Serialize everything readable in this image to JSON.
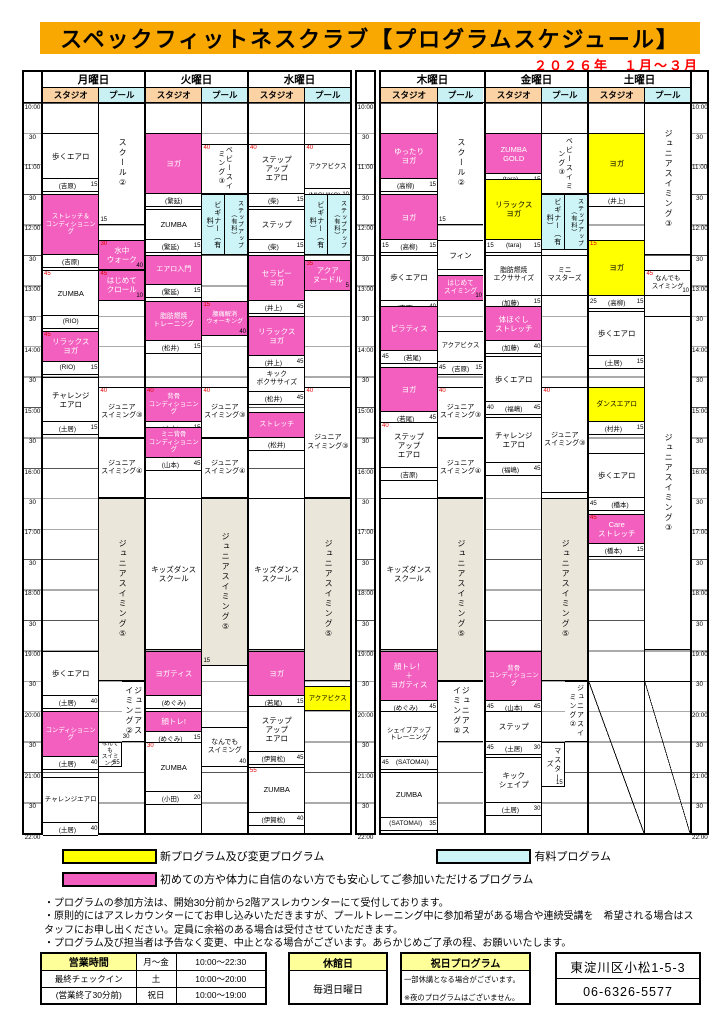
{
  "title": "スペックフィットネスクラブ【プログラムスケジュール】",
  "period": "２０２６年　１月～３月",
  "areas": [
    "スタジオ",
    "プール"
  ],
  "time_labels": [
    "10:00",
    "30",
    "11:00",
    "30",
    "12:00",
    "30",
    "13:00",
    "30",
    "14:00",
    "30",
    "15:00",
    "30",
    "16:00",
    "30",
    "17:00",
    "30",
    "18:00",
    "30",
    "19:00",
    "30",
    "20:00",
    "30",
    "21:00",
    "30",
    "22:00"
  ],
  "colors": {
    "accent_orange": "#F8A800",
    "studio_header": "#FAD2A4",
    "pool_header": "#C9F0F3",
    "pink": "#F25FBE",
    "yellow": "#FFFF00",
    "paid_blue": "#CDF4F6",
    "beige": "#EAE6DA",
    "red_text": "#FF0000",
    "table_header_yellow": "#FFFF99"
  },
  "days": [
    {
      "name": "月曜日",
      "studio": [
        {
          "t": "歩くエアロ",
          "i": "(吉原)",
          "br": "15",
          "s": "10:30",
          "e": "11:15",
          "c": "white"
        },
        {
          "t": "ストレッチ＆\nコンディショニング",
          "i": "(吉原)",
          "s": "11:30",
          "e": "12:30",
          "c": "pink",
          "fs": 6.3
        },
        {
          "t": "ZUMBA",
          "i": "(RIO)",
          "tl": "45",
          "s": "12:45",
          "e": "13:30",
          "c": "white"
        },
        {
          "t": "リラックス\nヨガ",
          "i": "(RIO)",
          "tl": "45",
          "br": "15",
          "s": "13:45",
          "e": "14:15",
          "c": "pink"
        },
        {
          "t": "チャレンジ\nエアロ",
          "i": "(土居)",
          "br": "15",
          "s": "14:30",
          "e": "15:15",
          "c": "white"
        },
        {
          "t": "歩くエアロ",
          "i": "(土居)",
          "br": "40",
          "s": "19:00",
          "e": "19:45",
          "c": "white"
        },
        {
          "t": "コンディショニング",
          "i": "(土居)",
          "br": "40",
          "s": "20:00",
          "e": "20:45",
          "c": "pink",
          "fs": 6.3
        },
        {
          "t": "チャレンジエアロ",
          "i": "(土居)",
          "br": "40",
          "s": "21:05",
          "e": "21:50",
          "c": "white",
          "fs": 6.5
        }
      ],
      "pool": [
        {
          "t": "スクール②",
          "s": "10:00",
          "e": "12:00",
          "c": "white",
          "v": 1,
          "bl": "15"
        },
        {
          "t": "水中\nウォーク",
          "s": "12:15",
          "e": "12:45",
          "c": "pink",
          "tl": "30",
          "br": "40"
        },
        {
          "t": "はじめて\nクロール",
          "s": "12:45",
          "e": "13:15",
          "c": "pink",
          "tl": "45",
          "br": "10"
        },
        {
          "t": "ジュニア\nスイミング③",
          "s": "14:40",
          "e": "15:30",
          "c": "white",
          "tl": "40",
          "fs": 7
        },
        {
          "t": "ジュニア\nスイミング④",
          "s": "15:30",
          "e": "16:30",
          "c": "white",
          "fs": 7
        },
        {
          "t": "ジュニアスイミング⑤",
          "s": "16:30",
          "e": "19:30",
          "c": "beige",
          "v": 1
        },
        {
          "t": "ジュニアスイミング②",
          "s": "19:30",
          "e": "20:30",
          "c": "white",
          "v": 1,
          "lane": "R",
          "bl": "30"
        },
        {
          "t": "なんでも\nスイミング",
          "s": "20:30",
          "e": "20:55",
          "c": "white",
          "lane": "L",
          "br": "55",
          "fs": 5.6
        }
      ]
    },
    {
      "name": "火曜日",
      "studio": [
        {
          "t": "ヨガ",
          "i": "(繁延)",
          "s": "10:30",
          "e": "11:30",
          "c": "pink"
        },
        {
          "t": "ZUMBA",
          "i": "(繁延)",
          "br": "15",
          "s": "11:45",
          "e": "12:15",
          "c": "white"
        },
        {
          "t": "エアロ入門",
          "i": "(繁延)",
          "br": "15",
          "s": "12:30",
          "e": "13:00",
          "c": "pink",
          "fs": 7
        },
        {
          "t": "脂肪燃焼\nトレーニング",
          "i": "(松井)",
          "br": "15",
          "s": "13:15",
          "e": "13:55",
          "c": "pink",
          "fs": 6.8
        },
        {
          "t": "背骨\nコンディショニング",
          "i": "(山本)",
          "tl": "40",
          "br": "15",
          "s": "14:40",
          "e": "15:15",
          "c": "pink",
          "fs": 6.3
        },
        {
          "t": "ミニ背骨\nコンディショニング",
          "i": "(山本)",
          "br": "45",
          "s": "15:20",
          "e": "15:50",
          "c": "pink",
          "fs": 6.3
        },
        {
          "t": "キッズダンス\nスクール",
          "s": "16:30",
          "e": "19:00",
          "c": "white"
        },
        {
          "t": "ヨガティス",
          "i": "(めぐみ)",
          "s": "19:00",
          "e": "19:45",
          "c": "pink"
        },
        {
          "t": "顔トレ!",
          "i": "(めぐみ)",
          "br": "15",
          "s": "20:00",
          "e": "20:20",
          "c": "pink"
        },
        {
          "t": "ZUMBA",
          "i": "(小田)",
          "tl": "30",
          "br": "20",
          "s": "20:30",
          "e": "21:20",
          "c": "white"
        }
      ],
      "pool": [
        {
          "t": "ベビースイミング③",
          "s": "10:40",
          "e": "11:30",
          "c": "white",
          "v": 1,
          "tl": "40",
          "fs": 7
        },
        {
          "t": "ビギナー（有料）",
          "s": "11:30",
          "e": "12:30",
          "c": "blue",
          "v": 1,
          "lane": "L"
        },
        {
          "t": "ステップアップ（有料）",
          "s": "11:30",
          "e": "12:30",
          "c": "blue",
          "v": 1,
          "lane": "R",
          "fs": 6
        },
        {
          "t": "腰痛解消\nウォーキング",
          "s": "13:15",
          "e": "13:50",
          "c": "pink",
          "tl": "15",
          "br": "40",
          "fs": 6.2
        },
        {
          "t": "ジュニア\nスイミング③",
          "s": "14:40",
          "e": "15:30",
          "c": "white",
          "tl": "40",
          "fs": 7
        },
        {
          "t": "ジュニア\nスイミング④",
          "s": "15:30",
          "e": "16:30",
          "c": "white",
          "fs": 7
        },
        {
          "t": "ジュニアスイミング⑤",
          "s": "16:30",
          "e": "19:15",
          "c": "beige",
          "v": 1,
          "bl": "15"
        },
        {
          "t": "なんでも\nスイミング",
          "s": "20:15",
          "e": "20:55",
          "c": "white",
          "br": "40",
          "fs": 6.8
        }
      ]
    },
    {
      "name": "水曜日",
      "studio": [
        {
          "t": "ステップ\nアップ\nエアロ",
          "i": "(柴)",
          "tl": "40",
          "br": "15",
          "s": "10:40",
          "e": "11:30",
          "c": "white"
        },
        {
          "t": "ステップ",
          "i": "(柴)",
          "br": "15",
          "s": "11:45",
          "e": "12:15",
          "c": "white"
        },
        {
          "t": "セラピー\nヨガ",
          "i": "(井上)",
          "br": "45",
          "s": "12:30",
          "e": "13:15",
          "c": "pink"
        },
        {
          "t": "リラックス\nヨガ",
          "i": "(井上)",
          "br": "45",
          "s": "13:30",
          "e": "14:10",
          "c": "pink"
        },
        {
          "t": "キック\nボクササイズ",
          "i": "(松井)",
          "br": "45",
          "s": "14:20",
          "e": "14:45",
          "c": "white",
          "fs": 6.8
        },
        {
          "t": "ストレッチ",
          "i": "(松井)",
          "s": "15:05",
          "e": "15:30",
          "c": "pink",
          "fs": 7
        },
        {
          "t": "キッズダンス\nスクール",
          "s": "16:30",
          "e": "19:00",
          "c": "white"
        },
        {
          "t": "ヨガ",
          "i": "(若尾)",
          "br": "15",
          "s": "19:00",
          "e": "19:45",
          "c": "pink"
        },
        {
          "t": "ステップ\nアップ\nエアロ",
          "i": "(伊賀松)",
          "br": "45",
          "s": "19:55",
          "e": "20:40",
          "c": "white"
        },
        {
          "t": "ZUMBA",
          "i": "(伊賀松)",
          "tl": "55",
          "br": "40",
          "s": "20:55",
          "e": "21:40",
          "c": "white"
        }
      ],
      "pool": [
        {
          "t": "アクアビクス",
          "i": "(MICHIKO)",
          "tl": "40",
          "br": "10",
          "s": "10:40",
          "e": "11:25",
          "c": "white",
          "fs": 6.4
        },
        {
          "t": "ビギナー（有料）",
          "s": "11:30",
          "e": "12:30",
          "c": "blue",
          "v": 1,
          "lane": "L"
        },
        {
          "t": "ステップアップ（有料）",
          "s": "11:30",
          "e": "12:30",
          "c": "blue",
          "v": 1,
          "lane": "R",
          "fs": 6
        },
        {
          "t": "アクア\nヌードル",
          "s": "12:35",
          "e": "13:05",
          "c": "pink",
          "tl": "35",
          "br": "5"
        },
        {
          "t": "ジュニア\nスイミング③",
          "s": "14:40",
          "e": "16:30",
          "c": "white",
          "tl": "40",
          "fs": 7
        },
        {
          "t": "ジュニアスイミング⑤",
          "s": "16:30",
          "e": "19:30",
          "c": "beige",
          "v": 1
        },
        {
          "t": "アクアビクス",
          "s": "19:35",
          "e": "20:00",
          "c": "yellow",
          "fs": 6.4
        }
      ]
    },
    {
      "name": "木曜日",
      "studio": [
        {
          "t": "ゆったり\nヨガ",
          "i": "(高柳)",
          "br": "15",
          "s": "10:30",
          "e": "11:15",
          "c": "pink"
        },
        {
          "t": "ヨガ",
          "i": "(高柳)",
          "br": "15",
          "bl": "15",
          "s": "11:30",
          "e": "12:15",
          "c": "pink"
        },
        {
          "t": "歩くエアロ",
          "i": "(吉原)",
          "br": "40",
          "s": "12:30",
          "e": "13:15",
          "c": "white"
        },
        {
          "t": "ピラティス",
          "i": "(若尾)",
          "bl": "45",
          "s": "13:20",
          "e": "14:05",
          "c": "pink"
        },
        {
          "t": "ヨガ",
          "i": "(若尾)",
          "br": "45",
          "s": "14:20",
          "e": "15:05",
          "c": "pink"
        },
        {
          "t": "ステップ\nアップ\nエアロ",
          "i": "(吉原)",
          "tl": "40",
          "s": "15:15",
          "e": "16:00",
          "c": "white"
        },
        {
          "t": "キッズダンス\nスクール",
          "s": "16:30",
          "e": "19:00",
          "c": "white"
        },
        {
          "t": "顔トレ！\n＋\nヨガティス",
          "i": "(めぐみ)",
          "br": "45",
          "s": "19:00",
          "e": "19:50",
          "c": "pink"
        },
        {
          "t": "シェイプアップ\nトレーニング",
          "i": "(SATOMAI)",
          "bl": "45",
          "s": "20:00",
          "e": "20:45",
          "c": "white",
          "fs": 6.3
        },
        {
          "t": "ZUMBA",
          "i": "(SATOMAI)",
          "br": "35",
          "s": "21:00",
          "e": "21:45",
          "c": "white"
        }
      ],
      "pool": [
        {
          "t": "スクール②",
          "s": "10:00",
          "e": "12:00",
          "c": "white",
          "v": 1,
          "bl": "15"
        },
        {
          "t": "フィン",
          "s": "12:15",
          "e": "12:45",
          "c": "white"
        },
        {
          "t": "はじめて\nスイミング",
          "s": "12:50",
          "e": "13:15",
          "c": "pink",
          "br": "10",
          "fs": 6.6
        },
        {
          "t": "アクアビクス",
          "i": "(吉原)",
          "br": "15",
          "bl": "45",
          "s": "13:45",
          "e": "14:15",
          "c": "white",
          "fs": 6.4
        },
        {
          "t": "ジュニア\nスイミング③",
          "s": "14:40",
          "e": "15:30",
          "c": "white",
          "tl": "40",
          "fs": 7
        },
        {
          "t": "ジュニア\nスイミング④",
          "s": "15:30",
          "e": "16:30",
          "c": "white",
          "fs": 7
        },
        {
          "t": "ジュニアスイミング⑤",
          "s": "16:30",
          "e": "19:30",
          "c": "beige",
          "v": 1
        },
        {
          "t": "ジュニアスイミング②",
          "s": "19:30",
          "e": "20:30",
          "c": "white",
          "v": 1
        }
      ]
    },
    {
      "name": "金曜日",
      "studio": [
        {
          "t": "ZUMBA\nGOLD",
          "i": "(tara)",
          "br": "15",
          "s": "10:30",
          "e": "11:10",
          "c": "pink"
        },
        {
          "t": "リラックス\nヨガ",
          "i": "(tara)",
          "br": "15",
          "bl": "15",
          "s": "11:15",
          "e": "12:15",
          "c": "yellow"
        },
        {
          "t": "脂肪燃焼\nエクササイズ",
          "i": "(加藤)",
          "br": "15",
          "s": "12:30",
          "e": "13:10",
          "c": "white",
          "fs": 6.8
        },
        {
          "t": "体ほぐし\nストレッチ",
          "i": "(加藤)",
          "br": "40",
          "s": "13:20",
          "e": "13:55",
          "c": "pink"
        },
        {
          "t": "歩くエアロ",
          "i": "(福嶋)",
          "br": "45",
          "bl": "40",
          "s": "14:10",
          "e": "14:55",
          "c": "white"
        },
        {
          "t": "チャレンジ\nエアロ",
          "i": "(福嶋)",
          "br": "45",
          "s": "15:10",
          "e": "15:55",
          "c": "white"
        },
        {
          "t": "背骨\nコンディショニング",
          "i": "(山本)",
          "br": "45",
          "bl": "45",
          "s": "19:00",
          "e": "19:50",
          "c": "pink",
          "fs": 6.3
        },
        {
          "t": "ステップ",
          "i": "(土居)",
          "br": "30",
          "bl": "45",
          "s": "20:00",
          "e": "20:30",
          "c": "white"
        },
        {
          "t": "キック\nシェイプ",
          "i": "(土居)",
          "br": "30",
          "s": "20:45",
          "e": "21:30",
          "c": "white"
        }
      ],
      "pool": [
        {
          "t": "ベビースイミング③",
          "s": "10:30",
          "e": "11:30",
          "c": "white",
          "v": 1,
          "fs": 7
        },
        {
          "t": "ビギナー（有料）",
          "s": "11:30",
          "e": "12:25",
          "c": "blue",
          "v": 1,
          "lane": "L"
        },
        {
          "t": "ステップアップ（有料）",
          "s": "11:30",
          "e": "12:25",
          "c": "blue",
          "v": 1,
          "lane": "R",
          "fs": 6
        },
        {
          "t": "ミニ\nマスターズ",
          "s": "12:30",
          "e": "13:10",
          "c": "white",
          "fs": 6.8
        },
        {
          "t": "ジュニア\nスイミング③",
          "s": "14:40",
          "e": "16:25",
          "c": "white",
          "tl": "40",
          "fs": 7
        },
        {
          "t": "ジュニアスイミング⑤",
          "s": "16:30",
          "e": "19:30",
          "c": "beige",
          "v": 1
        },
        {
          "t": "ジュニアスイミング②",
          "s": "19:30",
          "e": "20:30",
          "c": "white",
          "v": 1,
          "lane": "R",
          "fs": 7
        },
        {
          "t": "マスターズ",
          "s": "20:30",
          "e": "21:15",
          "c": "white",
          "v": 1,
          "lane": "L",
          "br": "15",
          "fs": 7
        }
      ]
    },
    {
      "name": "土曜日",
      "studio": [
        {
          "t": "ヨガ",
          "i": "(井上)",
          "s": "10:30",
          "e": "11:30",
          "c": "yellow"
        },
        {
          "t": "ヨガ",
          "i": "(高柳)",
          "tl": "15",
          "br": "15",
          "bl": "25",
          "s": "12:15",
          "e": "13:10",
          "c": "yellow"
        },
        {
          "t": "歩くエアロ",
          "i": "(土居)",
          "br": "15",
          "s": "13:25",
          "e": "14:10",
          "c": "white"
        },
        {
          "t": "ダンスエアロ",
          "i": "(村井)",
          "br": "15",
          "s": "14:40",
          "e": "15:15",
          "c": "yellow",
          "fs": 6.8
        },
        {
          "t": "歩くエアロ",
          "i": "(橋本)",
          "bl": "45",
          "s": "15:45",
          "e": "16:30",
          "c": "white"
        },
        {
          "t": "Care\nストレッチ",
          "i": "(橋本)",
          "tl": "45",
          "br": "15",
          "s": "16:45",
          "e": "17:15",
          "c": "pink"
        },
        {
          "t": "",
          "s": "19:30",
          "e": "22:00",
          "c": "diag"
        }
      ],
      "pool": [
        {
          "t": "ジュニアスイミング③",
          "s": "10:00",
          "e": "12:30",
          "c": "white",
          "v": 1
        },
        {
          "t": "なんでも\nスイミング",
          "s": "12:45",
          "e": "13:10",
          "c": "white",
          "tl": "45",
          "br": "10",
          "fs": 6.4
        },
        {
          "t": "ジュニアスイミング③",
          "s": "13:30",
          "e": "19:00",
          "c": "white",
          "v": 1
        },
        {
          "t": "",
          "s": "19:30",
          "e": "22:00",
          "c": "diag"
        }
      ]
    }
  ],
  "legend": [
    {
      "color": "yellow",
      "label": "新プログラム及び変更プログラム"
    },
    {
      "color": "blue",
      "label": "有料プログラム"
    },
    {
      "color": "pink",
      "label": "初めての方や体力に自信のない方でも安心してご参加いただけるプログラム"
    }
  ],
  "notes": [
    "・プログラムの参加方法は、開始30分前から2階アスレカウンターにて受付しております。",
    "・原則的にはアスレカウンターにてお申し込みいただきますが、プールトレーニング中に参加希望がある場合や連続受講を　希望される場合はスタッフにお申し出ください。定員に余裕のある場合は受付させていただきます。",
    "・プログラム及び担当者は予告なく変更、中止となる場合がございます。あらかじめご了承の程、お願いいたします。"
  ],
  "info": {
    "hours": {
      "rows": [
        [
          "営業時間",
          "月～金",
          "10:00～22:30"
        ],
        [
          "最終チェックイン",
          "土",
          "10:00～20:00"
        ],
        [
          "(営業終了30分前)",
          "祝日",
          "10:00～19:00"
        ]
      ]
    },
    "closed": {
      "title": "休館日",
      "value": "毎週日曜日"
    },
    "holiday": {
      "title": "祝日プログラム",
      "lines": [
        "一部休講となる場合がございます。",
        "※夜のプログラムはございません。"
      ]
    },
    "contact": {
      "address": "東淀川区小松1-5-3",
      "phone": "06-6326-5577"
    }
  }
}
